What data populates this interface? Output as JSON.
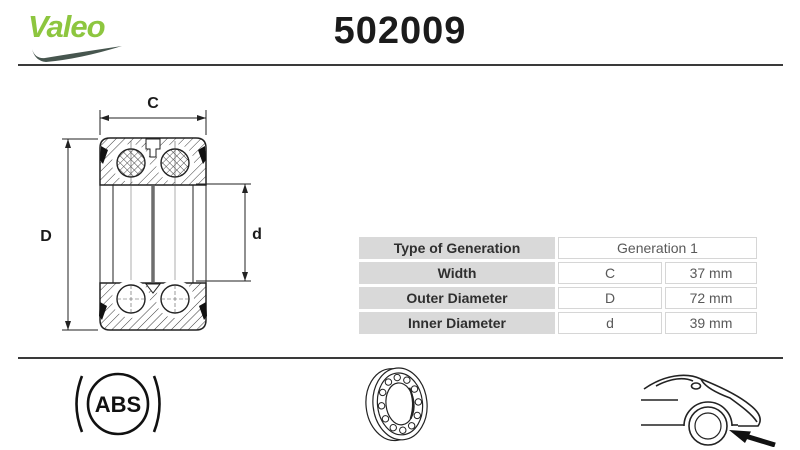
{
  "header": {
    "brand": "Valeo",
    "part_number": "502009"
  },
  "diagram": {
    "width_label": "C",
    "outer_diameter_label": "D",
    "inner_diameter_label": "d"
  },
  "spec_table": {
    "rows": [
      {
        "label": "Type of Generation",
        "symbol": "",
        "value": "Generation 1"
      },
      {
        "label": "Width",
        "symbol": "C",
        "value": "37 mm"
      },
      {
        "label": "Outer Diameter",
        "symbol": "D",
        "value": "72 mm"
      },
      {
        "label": "Inner Diameter",
        "symbol": "d",
        "value": "39 mm"
      }
    ]
  },
  "footer": {
    "abs_label": "ABS"
  },
  "colors": {
    "brand_green": "#8dc63f",
    "swoosh_dark": "#47564f",
    "text_dark": "#1b1b1b",
    "table_label_bg": "#d9d9d9",
    "table_value_text": "#595959",
    "rule": "#3a3a3a"
  }
}
